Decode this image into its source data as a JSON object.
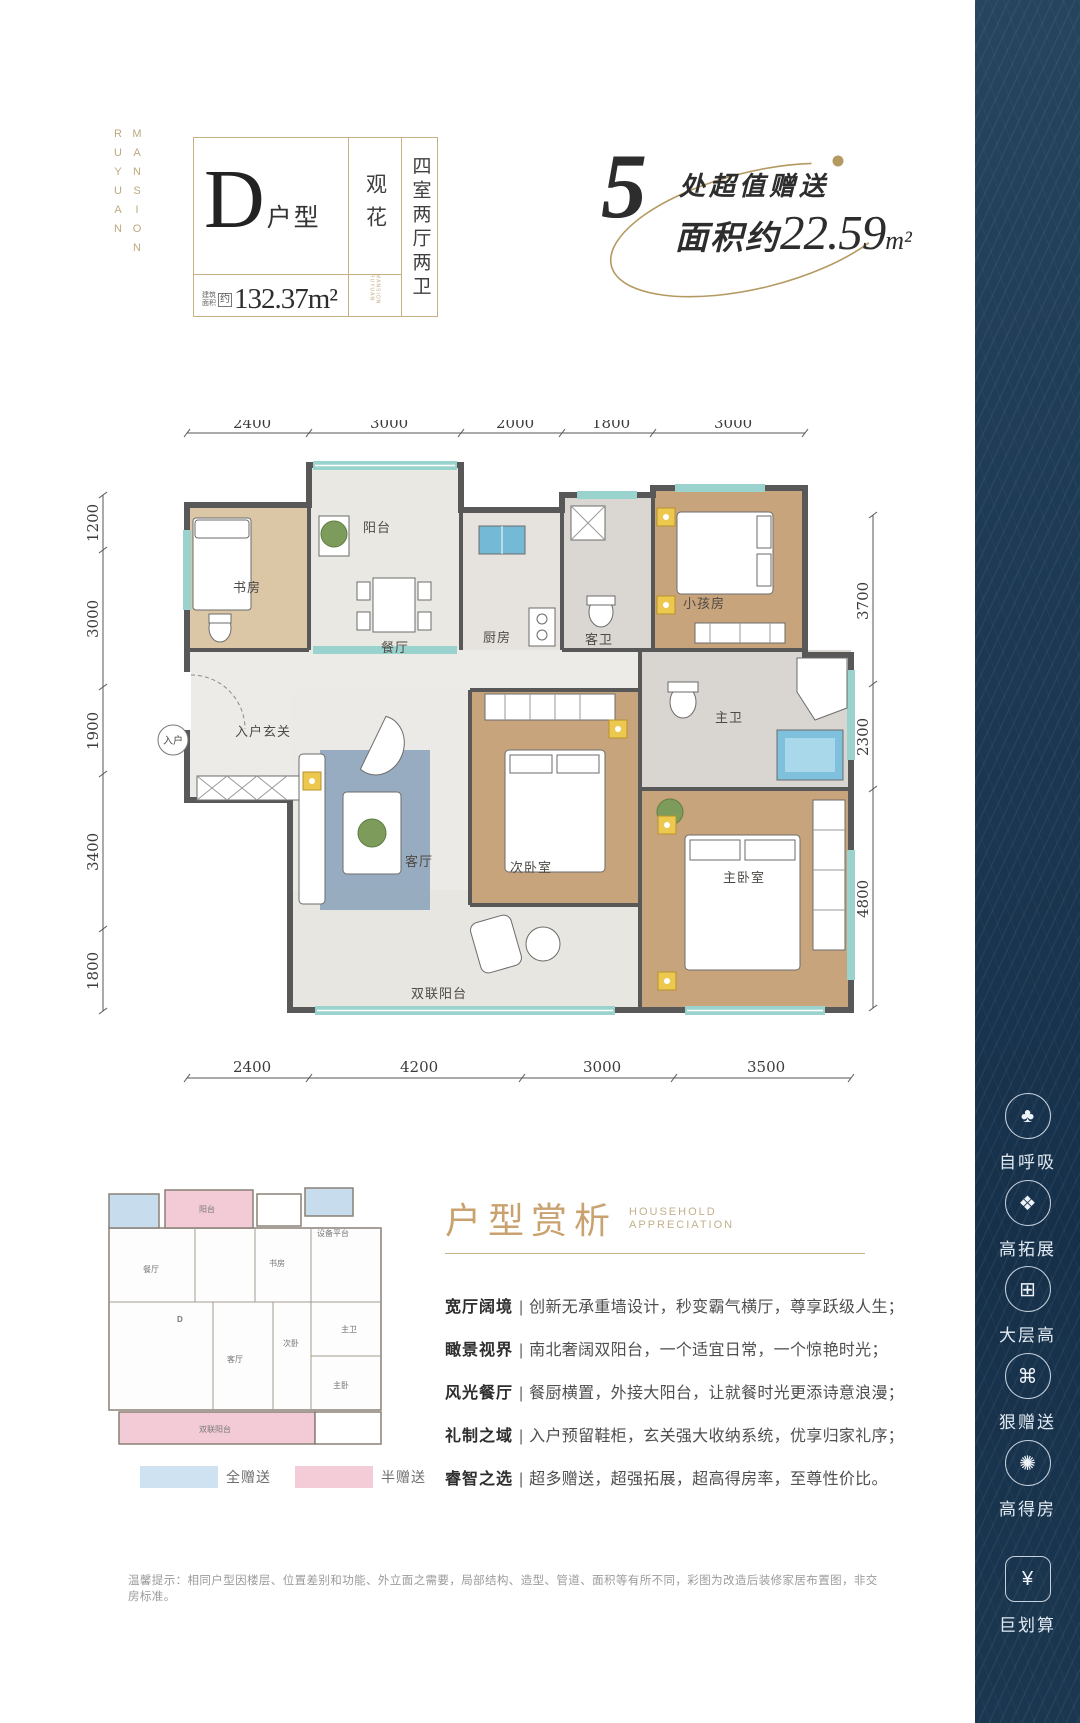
{
  "brand": {
    "col1": "RUYUAN",
    "col2": "MANSION"
  },
  "unit_card": {
    "type_letter": "D",
    "type_suffix": "户型",
    "view_label": "观花",
    "layout_label": "四室两厅两卫",
    "area_label_l1": "建筑",
    "area_label_l2": "面积",
    "area_approx": "约",
    "area_value": "132.37m²",
    "watermark": "RUYUAN MANSION"
  },
  "gift_badge": {
    "number": "5",
    "line1": "处超值赠送",
    "line2_prefix": "面积约",
    "line2_value": "22.59",
    "line2_unit": "m²"
  },
  "plan": {
    "dims": {
      "top": [
        "2400",
        "3000",
        "2000",
        "1800",
        "3000"
      ],
      "bottom": [
        "2400",
        "4200",
        "3000",
        "3500"
      ],
      "left": [
        "1200",
        "3000",
        "1900",
        "3400",
        "1800"
      ],
      "right": [
        "3700",
        "2300",
        "4800"
      ]
    },
    "rooms": {
      "balcony": "阳台",
      "study": "书房",
      "dining": "餐厅",
      "kitchen": "厨房",
      "guest_bath": "客卫",
      "kids_room": "小孩房",
      "entry_hall": "入户玄关",
      "entry": "入户",
      "living": "客厅",
      "second_bedroom": "次卧室",
      "master_bath": "主卫",
      "master_bedroom": "主卧室",
      "double_balcony": "双联阳台"
    }
  },
  "mini_plan": {
    "d_label": "D",
    "rooms": {
      "balcony": "阳台",
      "equip_platform": "设备平台",
      "study": "书房",
      "dining": "餐厅",
      "living": "客厅",
      "second_bedroom": "次卧",
      "master_bath": "主卫",
      "master_bedroom": "主卧",
      "double_balcony": "双联阳台"
    },
    "legend": [
      {
        "label": "全赠送",
        "color": "#cfe2f1"
      },
      {
        "label": "半赠送",
        "color": "#f4ccd7"
      }
    ]
  },
  "analysis": {
    "title": "户型赏析",
    "subtitle_line1": "HOUSEHOLD",
    "subtitle_line2": "APPRECIATION",
    "sep": "|",
    "items": [
      {
        "head": "宽厅阔境",
        "body": "创新无承重墙设计，秒变霸气横厅，尊享跃级人生；"
      },
      {
        "head": "瞰景视界",
        "body": "南北奢阔双阳台，一个适宜日常，一个惊艳时光；"
      },
      {
        "head": "风光餐厅",
        "body": "餐厨横置，外接大阳台，让就餐时光更添诗意浪漫；"
      },
      {
        "head": "礼制之域",
        "body": "入户预留鞋柜，玄关强大收纳系统，优享归家礼序；"
      },
      {
        "head": "睿智之选",
        "body": "超多赠送，超强拓展，超高得房率，至尊性价比。"
      }
    ]
  },
  "sidebar": {
    "items": [
      {
        "label": "自呼吸",
        "glyph": "♣"
      },
      {
        "label": "高拓展",
        "glyph": "❖"
      },
      {
        "label": "大层高",
        "glyph": "⊞"
      },
      {
        "label": "狠赠送",
        "glyph": "⌘"
      },
      {
        "label": "高得房",
        "glyph": "✺"
      },
      {
        "label": "巨划算",
        "glyph": "¥"
      }
    ]
  },
  "disclaimer": "温馨提示：相同户型因楼层、位置差别和功能、外立面之需要，局部结构、造型、管道、面积等有所不同，彩图为改造后装修家居布置图，非交房标准。",
  "colors": {
    "gold": "#b49a62",
    "navy": "#1c3852",
    "wall": "#585858",
    "window_teal": "#9ad2cd",
    "legend_blue": "#cfe2f1",
    "legend_pink": "#f4ccd7"
  }
}
